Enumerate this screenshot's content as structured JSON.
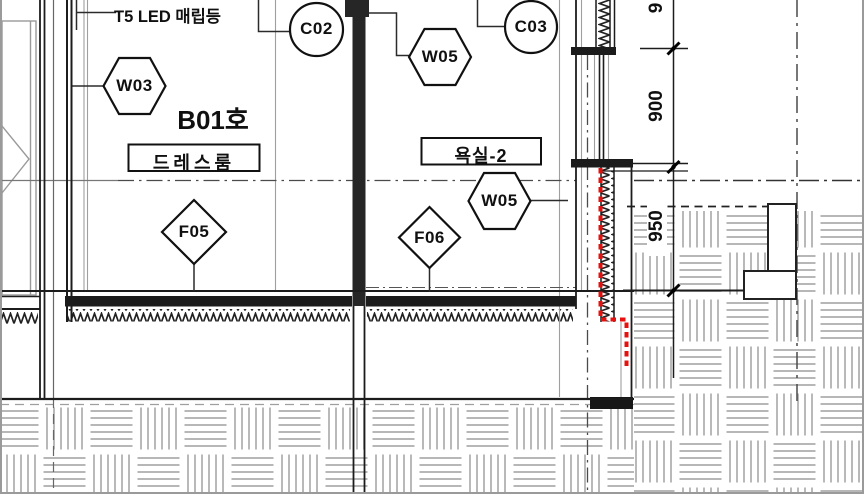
{
  "floorplan": {
    "colors": {
      "highlight_red": "#e8100e",
      "ink": "#1c1c1c",
      "paving_gray": "#adadad"
    },
    "note_t5": "T5 LED 매립등",
    "room": {
      "unit": "B01호",
      "dress": "드레스룸",
      "bath": "욕실-2"
    },
    "symbols": {
      "w03": "W03",
      "c02": "C02",
      "w05_upper": "W05",
      "c03": "C03",
      "w05_lower": "W05",
      "f05": "F05",
      "f06": "F06"
    },
    "dimensions": {
      "top_partial": "9",
      "upper": "900",
      "lower": "950"
    }
  }
}
